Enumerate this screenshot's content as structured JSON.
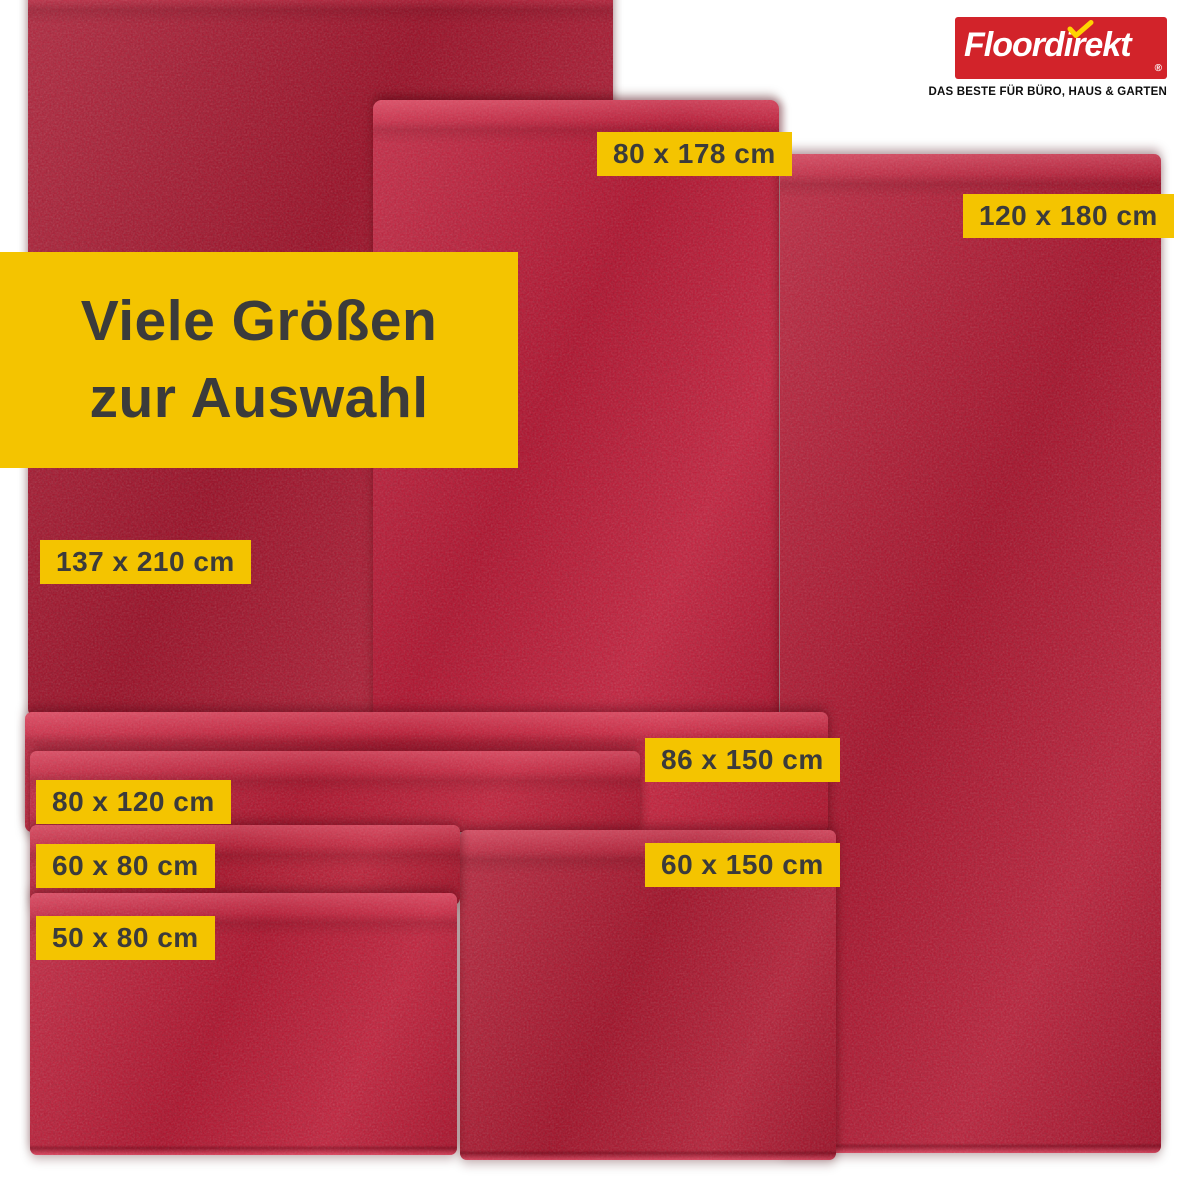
{
  "colors": {
    "accent_yellow": "#f4c400",
    "label_text": "#3b3b3b",
    "rug_red": "#c00f2d",
    "logo_red": "#d2232a",
    "check_yellow": "#ffd400",
    "background": "#ffffff"
  },
  "logo": {
    "brand": "Floordirekt",
    "registered_mark": "®",
    "tagline": "DAS BESTE FÜR BÜRO, HAUS & GARTEN"
  },
  "banner": {
    "line1": "Viele Größen",
    "line2": "zur Auswahl"
  },
  "sizes": {
    "s80x178": "80 x 178 cm",
    "s120x180": "120 x 180 cm",
    "s137x210": "137 x 210 cm",
    "s86x150": "86 x 150 cm",
    "s80x120": "80 x 120 cm",
    "s60x80": "60 x 80 cm",
    "s60x150": "60 x 150 cm",
    "s50x80": "50 x 80 cm"
  }
}
